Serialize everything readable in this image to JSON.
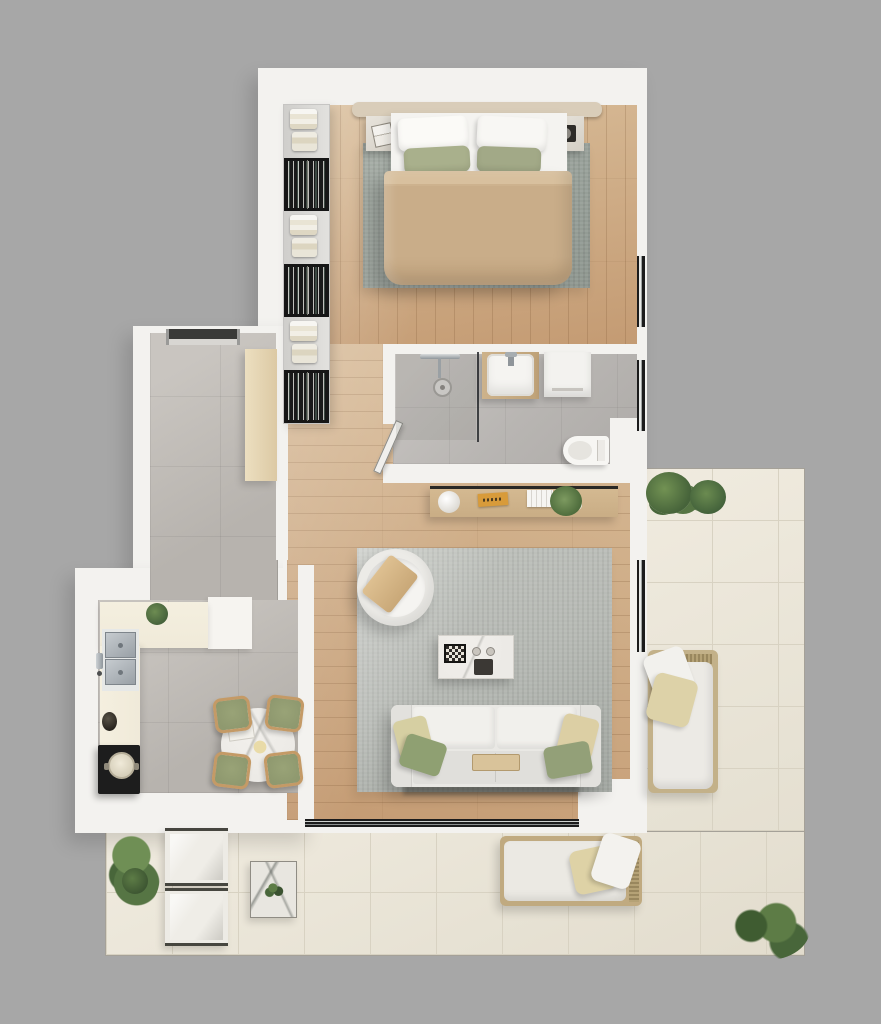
{
  "meta": {
    "type": "3d-floor-plan-render",
    "description": "Top-down 3D rendering of a one-bedroom apartment with wrap-around terrace on a gray backdrop",
    "visible_text": []
  },
  "palette": {
    "background": "#a7a7a7",
    "wall": "#f3f2ef",
    "wood": "#d8bc98",
    "wood_dark": "#c49b73",
    "tile_gray": "#b7b3ae",
    "tile_gray_light": "#c9c5c0",
    "bath_tile": "#b8b5b2",
    "terrace_tile": "#ebe6d9",
    "terrace_line": "#d8d2c2",
    "terrace_edge": "#a5a198",
    "rug_bedroom": "#9ca49d",
    "rug_living": "#b6b9b4",
    "bed_duvet": "#c9ad89",
    "pillow_green": "#a9b08c",
    "headboard": "#d9cdb9",
    "sofa": "#e9e8e4",
    "counter": "#f0ead9",
    "stove": "#1d1d1d",
    "steel": "#b2b8bc",
    "wardrobe_dark": "#161616",
    "wardrobe_light": "#d9d8d6",
    "console_wood": "#c9ad85",
    "chair_cushion": "#8f996f",
    "chair_wood": "#c49a66",
    "plant": "#53703f",
    "window_frame": "#1c1c1c",
    "marble": "#eceae6",
    "accent_book": "#d89b3a"
  },
  "rooms": {
    "bedroom": {
      "furniture": [
        "double-bed",
        "headboard",
        "white-pillows",
        "green-accent-pillows",
        "beige-duvet",
        "gray-area-rug",
        "nightstand-left",
        "nightstand-right",
        "open-wardrobe"
      ],
      "wardrobe_sections": [
        "linen",
        "clothes",
        "linen",
        "clothes",
        "linen",
        "clothes"
      ]
    },
    "bathroom": {
      "furniture": [
        "walk-in-shower",
        "shower-fixture",
        "floor-drain",
        "glass-divider",
        "vanity-sink",
        "washing-machine",
        "toilet",
        "open-door"
      ]
    },
    "hallway": {
      "furniture": [
        "entry-door",
        "storage-sideboard"
      ]
    },
    "kitchen": {
      "furniture": [
        "l-shaped-counter",
        "double-basin-sink",
        "wall-faucet",
        "cooktop",
        "cooking-pot",
        "counter-plant",
        "tall-white-cabinet",
        "round-marble-dining-table",
        "dining-chairs",
        "flower-centerpiece",
        "table-book"
      ]
    },
    "living_room": {
      "furniture": [
        "three-seat-sofa",
        "throw-pillows",
        "center-tray",
        "marble-coffee-table",
        "chessboard",
        "cups",
        "round-armchair",
        "throw-blanket",
        "gray-area-rug",
        "wood-console",
        "vase",
        "books",
        "flower-pot"
      ]
    },
    "terrace": {
      "furniture": [
        "lounge-chair",
        "daybed",
        "bench-pair",
        "marble-side-table",
        "potted-plants"
      ]
    }
  }
}
